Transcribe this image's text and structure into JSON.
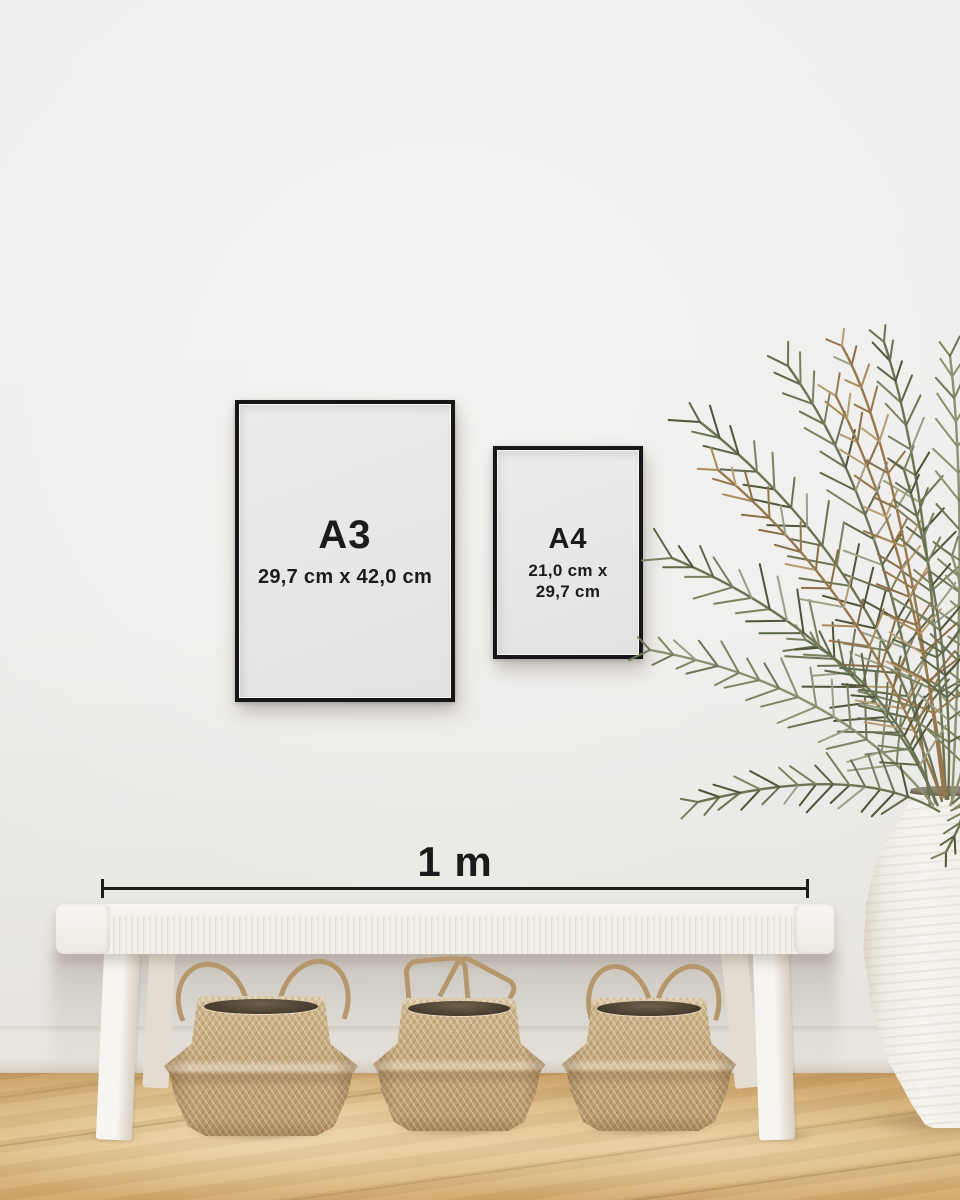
{
  "frames": [
    {
      "label": "A3",
      "dims1": "29,7 cm x 42,0 cm"
    },
    {
      "label": "A4",
      "dims1": "21,0 cm x",
      "dims2": "29,7 cm"
    }
  ],
  "scale_bar": {
    "label": "1 m"
  },
  "colors": {
    "wall": "#edecea",
    "text": "#1b1b1d",
    "frame_border": "#17171a",
    "frame_paper": "#e9e8e6",
    "bench_white": "#f0ece6",
    "basket_tan": "#c5a87c",
    "floor_oak": "#d9b67e",
    "vase_white": "#f2efe8",
    "plant_greens": [
      "#5d6749",
      "#6a7453",
      "#798160",
      "#4d553b",
      "#9aa087"
    ],
    "plant_olives": [
      "#7d8463",
      "#8b9172",
      "#6e765a"
    ],
    "plant_browns": [
      "#a8895a",
      "#96784c",
      "#b59e74",
      "#8a6f46"
    ]
  }
}
